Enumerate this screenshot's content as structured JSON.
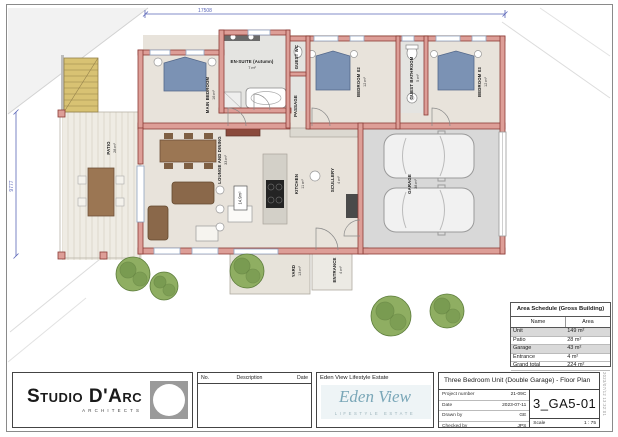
{
  "plan": {
    "dim_top": "17508",
    "dim_left": "9777",
    "floor_tag": "14.9m²",
    "rooms": [
      {
        "name": "MAIN BEDROOM",
        "area": "16 m²"
      },
      {
        "name": "EN-SUITE (Autumn)",
        "area": "7 m²"
      },
      {
        "name": "GUEST WC",
        "area": ""
      },
      {
        "name": "PASSAGE",
        "area": ""
      },
      {
        "name": "BEDROOM 02",
        "area": "12 m²"
      },
      {
        "name": "GUEST BATHROOM",
        "area": "5 m²"
      },
      {
        "name": "BEDROOM 03",
        "area": "12 m²"
      },
      {
        "name": "LOUNGE AND DINING",
        "area": "33 m²"
      },
      {
        "name": "KITCHEN",
        "area": "11 m²"
      },
      {
        "name": "SCULLERY",
        "area": "4 m²"
      },
      {
        "name": "GARAGE",
        "area": "38 m²"
      },
      {
        "name": "PATIO",
        "area": "28 m²"
      },
      {
        "name": "YARD",
        "area": "13 m²"
      },
      {
        "name": "ENTRANCE",
        "area": "4 m²"
      }
    ]
  },
  "schedule": {
    "title": "Area Schedule (Gross Building)",
    "col_name": "Name",
    "col_area": "Area",
    "rows": [
      {
        "name": "Unit",
        "area": "149 m²"
      },
      {
        "name": "Patio",
        "area": "28 m²"
      },
      {
        "name": "Garage",
        "area": "43 m²"
      },
      {
        "name": "Entrance",
        "area": "4 m²"
      },
      {
        "name": "Grand total",
        "area": "224 m²"
      }
    ]
  },
  "tb": {
    "arch": {
      "name": "Studio D'Arc",
      "sub": "ARCHITECTS"
    },
    "rev": {
      "no": "No.",
      "desc": "Description",
      "date": "Date"
    },
    "client": {
      "header": "Eden View Lifestyle Estate",
      "script": "Eden View",
      "sub": "LIFESTYLE ESTATE"
    },
    "drawing": {
      "title": "Three Bedroom Unit (Double Garage) - Floor Plan",
      "number": "3_GA5-01",
      "scale_label": "Scale",
      "scale_value": "1 : 75",
      "fields": [
        {
          "label": "Project number",
          "value": "21-09C"
        },
        {
          "label": "Date",
          "value": "2023-07-11"
        },
        {
          "label": "Drawn by",
          "value": "GE"
        },
        {
          "label": "Checked by",
          "value": "JPS"
        }
      ]
    },
    "stamp": "2023/07/12 13:32:01"
  },
  "colors": {
    "wall": "#dd9e97",
    "wall_edge": "#8c3b35",
    "bed": "#7b92b4",
    "tree": "#8fae62",
    "dimension": "#5a66b8",
    "eden_accent": "#7aa7b8"
  }
}
